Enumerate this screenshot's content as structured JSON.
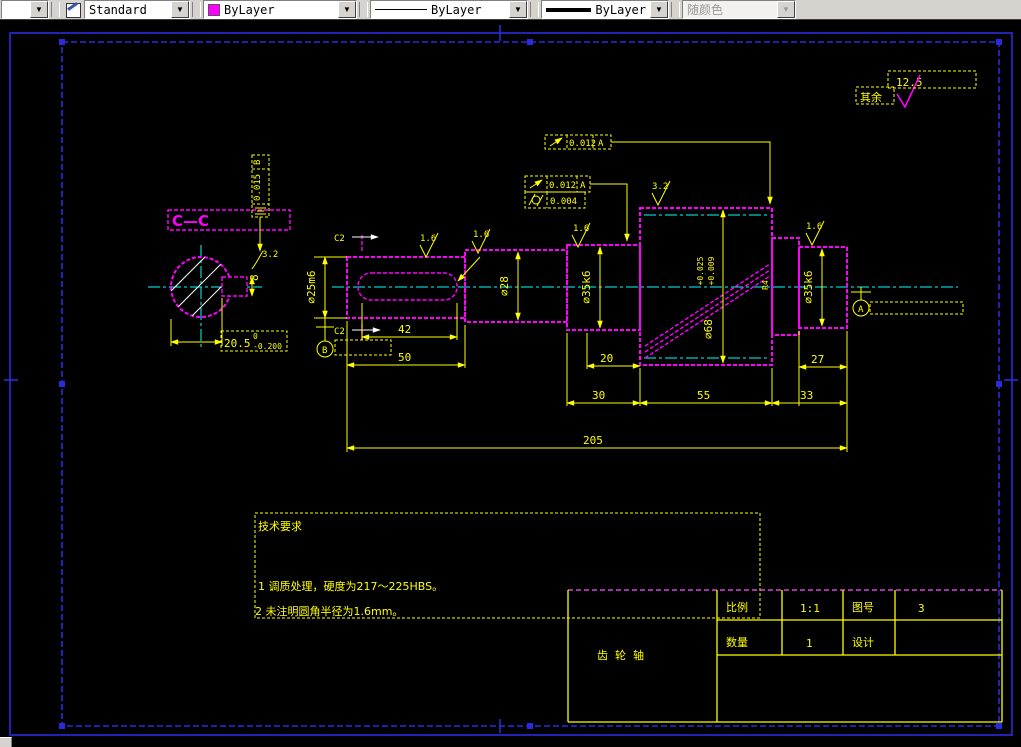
{
  "toolbar": {
    "text_style": {
      "value": "Standard"
    },
    "color": {
      "value": "ByLayer",
      "swatch": "#ff00ff"
    },
    "linetype": {
      "value": "ByLayer"
    },
    "lineweight": {
      "value": "ByLayer"
    },
    "plot_style": {
      "value": "随颜色"
    },
    "dropdown_glyph": "▼"
  },
  "colors": {
    "geometry": "#ff00ff",
    "annotation": "#ffff00",
    "centerline": "#00ffff",
    "frame": "#2a2ae0",
    "hatch": "#ffffff"
  },
  "drawing": {
    "surface_default": {
      "label": "其余",
      "roughness": "12.5"
    },
    "section_label": "C—C",
    "roughness_marks": {
      "keyway_shaft": "1.6",
      "step_shaft": "1.6",
      "left_journal": "1.6",
      "gear": "3.2",
      "right_journal": "1.6",
      "section_keyway": "3.2"
    },
    "gdt": {
      "frame1": {
        "symbol": "circular-runout",
        "value": "0.012",
        "datum": "A"
      },
      "frame2": {
        "symbol": "circular-runout",
        "value": "0.012",
        "datum": "A"
      },
      "frame3": {
        "symbol": "cylindricity",
        "value": "0.004"
      },
      "frame4": {
        "symbol": "symmetry",
        "value": "0.015",
        "datum": "B"
      }
    },
    "datum_a": "A",
    "datum_b": "B",
    "dims": {
      "keyway_length": "42",
      "left_section_length": "50",
      "spacer": "20",
      "left_journal_length": "30",
      "gear_length": "55",
      "right_journal_length": "27",
      "right_step_length": "33",
      "total_length": "205",
      "dia_left": "∅25m6",
      "dia_step": "∅28",
      "dia_left_journal": "∅35k6",
      "dia_gear": "∅68",
      "dia_gear_tol_upper": "+0.025",
      "dia_gear_tol_lower": "+0.009",
      "dia_right_journal": "∅35k6",
      "fillet": "R4",
      "key_width": "8",
      "section_width": "20.5",
      "section_tol_upper": "0",
      "section_tol_lower": "-0.200",
      "chamfer_top": "C2",
      "chamfer_bottom": "C2"
    },
    "tech_requirements": {
      "title": "技术要求",
      "items": [
        "1   调质处理，硬度为217～225HBS。",
        "2   未注明圆角半径为1.6mm。"
      ]
    },
    "title_block": {
      "part_name": "齿轮轴",
      "scale_label": "比例",
      "scale_value": "1:1",
      "drawing_no_label": "图号",
      "drawing_no_value": "3",
      "quantity_label": "数量",
      "quantity_value": "1",
      "designer_label": "设计"
    }
  }
}
